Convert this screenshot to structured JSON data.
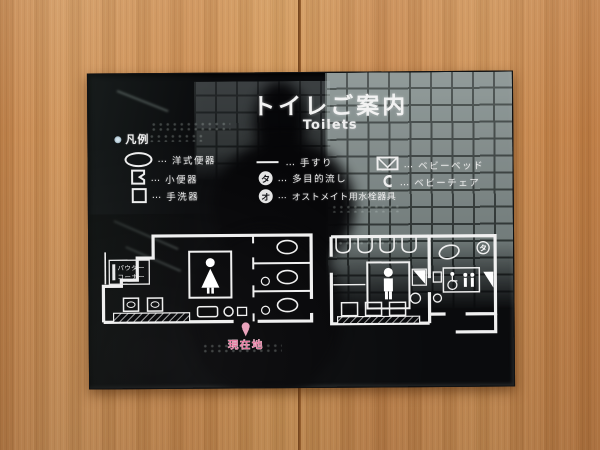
{
  "sign": {
    "title": "トイレご案内",
    "subtitle": "Toilets",
    "legend": {
      "heading": "凡例",
      "dots": "…",
      "col1": [
        {
          "label": "洋式便器"
        },
        {
          "label": "小便器"
        },
        {
          "label": "手洗器"
        }
      ],
      "col2": [
        {
          "label": "手すり"
        },
        {
          "symbol": "タ",
          "label": "多目的流し"
        },
        {
          "symbol": "オ",
          "label": "オストメイト用水栓器具"
        }
      ],
      "col3": [
        {
          "label": "ベビーベッド"
        },
        {
          "label": "ベビーチェア"
        }
      ]
    },
    "map": {
      "powder_corner": [
        "パウダー",
        "コーナー"
      ],
      "multipurpose_symbol": "タ",
      "current_location": "現在地"
    },
    "colors": {
      "panel_black": "#0a0b0d",
      "text_white": "#f0f0f0",
      "accent_pink": "#e5799f",
      "wood": "#c98b51"
    }
  }
}
